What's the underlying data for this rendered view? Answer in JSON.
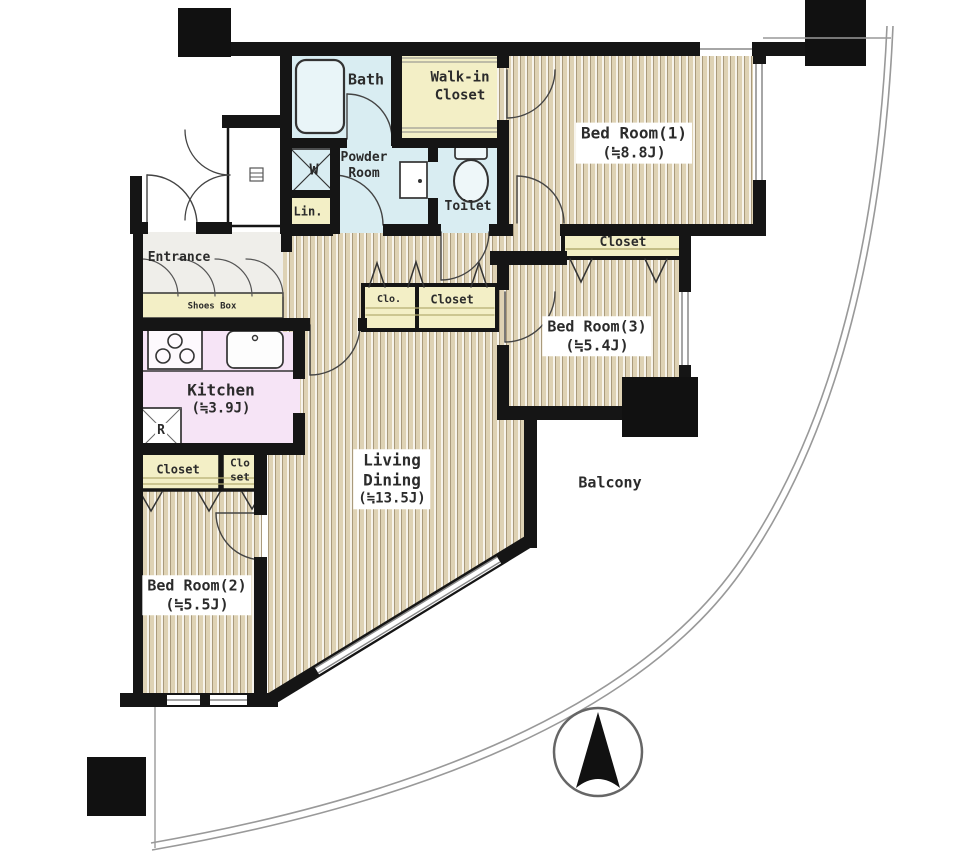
{
  "labels": {
    "bath": "Bath",
    "walk_in_closet_line1": "Walk-in",
    "walk_in_closet_line2": "Closet",
    "powder_line1": "Powder",
    "powder_line2": "Room",
    "washer": "W",
    "linen": "Lin.",
    "toilet": "Toilet",
    "bedroom1_name": "Bed Room(1)",
    "bedroom1_size": "(≒8.8J)",
    "bedroom1_closet": "Closet",
    "bedroom3_name": "Bed Room(3)",
    "bedroom3_size": "(≒5.4J)",
    "hall_closet_small": "Clo.",
    "hall_closet": "Closet",
    "entrance": "Entrance",
    "shoes_box": "Shoes Box",
    "kitchen_name": "Kitchen",
    "kitchen_size": "(≒3.9J)",
    "refrigerator": "R",
    "bedroom2_closet": "Closet",
    "bedroom2_closet2_line1": "Clo",
    "bedroom2_closet2_line2": "set",
    "bedroom2_name": "Bed Room(2)",
    "bedroom2_size": "(≒5.5J)",
    "living_line1": "Living",
    "living_line2": "Dining",
    "living_size": "(≒13.5J)",
    "balcony": "Balcony"
  },
  "colors": {
    "wall": "#151515",
    "wet_area": "#d9edf2",
    "closet_yellow": "#f3efc6",
    "kitchen_pink": "#f6e4f6",
    "floor_stripe": "#ded2b4",
    "curve_gray": "#999999"
  }
}
